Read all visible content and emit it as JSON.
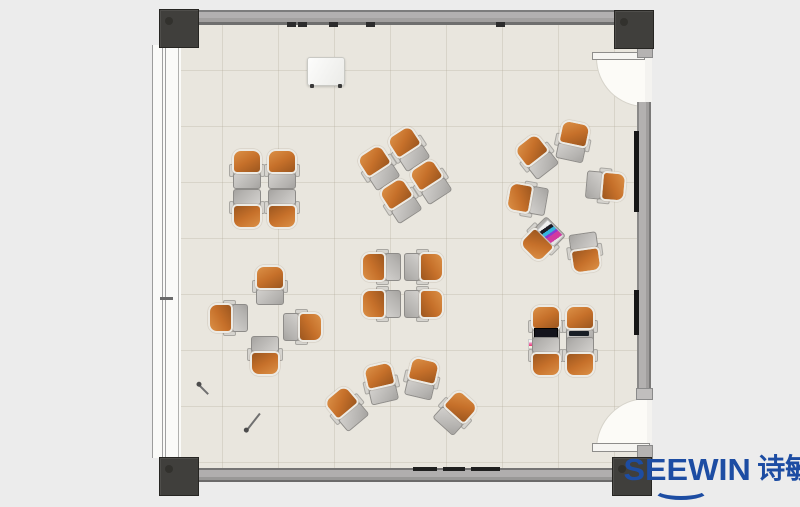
{
  "logo": {
    "brand_latin": "SEEWIN",
    "brand_cjk": "诗敏",
    "color": "#1d4da3"
  },
  "palette": {
    "canvas_bg": "#ececec",
    "floor": "#e9e6de",
    "floor_grid": "#cfc8ba",
    "wall_gray": "#a8a6a5",
    "column_dark": "#403f3c",
    "seat_orange": "#c6702a",
    "seat_shell_white": "#eceae4",
    "desk_gray": "#b5b3b0",
    "door_swing_white": "#fcfbf7",
    "screen_black": "#161616"
  },
  "furniture": {
    "unit_size": {
      "w": 34,
      "h": 40
    },
    "units": [
      {
        "id": "a1",
        "x": 247,
        "y": 169,
        "rot": 0
      },
      {
        "id": "a2",
        "x": 282,
        "y": 169,
        "rot": 0
      },
      {
        "id": "a3",
        "x": 247,
        "y": 209,
        "rot": 180
      },
      {
        "id": "a4",
        "x": 282,
        "y": 209,
        "rot": 180
      },
      {
        "id": "b1",
        "x": 378,
        "y": 167,
        "rot": -33
      },
      {
        "id": "b2",
        "x": 408,
        "y": 148,
        "rot": -33
      },
      {
        "id": "b3",
        "x": 400,
        "y": 200,
        "rot": -33
      },
      {
        "id": "b4",
        "x": 430,
        "y": 181,
        "rot": -33
      },
      {
        "id": "c1",
        "x": 573,
        "y": 141,
        "rot": 12
      },
      {
        "id": "c2",
        "x": 536,
        "y": 156,
        "rot": -38
      },
      {
        "id": "c3",
        "x": 527,
        "y": 199,
        "rot": -80
      },
      {
        "id": "c4",
        "x": 542,
        "y": 240,
        "rot": -135,
        "decor": "papers"
      },
      {
        "id": "c5",
        "x": 585,
        "y": 253,
        "rot": 172
      },
      {
        "id": "c6",
        "x": 606,
        "y": 186,
        "rot": 95
      },
      {
        "id": "d1",
        "x": 270,
        "y": 285,
        "rot": 0
      },
      {
        "id": "d2",
        "x": 228,
        "y": 318,
        "rot": -90
      },
      {
        "id": "d3",
        "x": 303,
        "y": 327,
        "rot": 90
      },
      {
        "id": "d4",
        "x": 265,
        "y": 356,
        "rot": 180
      },
      {
        "id": "e1",
        "x": 381,
        "y": 267,
        "rot": -90
      },
      {
        "id": "e2",
        "x": 424,
        "y": 267,
        "rot": 90
      },
      {
        "id": "e3",
        "x": 381,
        "y": 304,
        "rot": -90
      },
      {
        "id": "e4",
        "x": 424,
        "y": 304,
        "rot": 90
      },
      {
        "id": "f1",
        "x": 346,
        "y": 408,
        "rot": -40
      },
      {
        "id": "f2",
        "x": 381,
        "y": 383,
        "rot": -13
      },
      {
        "id": "f3",
        "x": 422,
        "y": 378,
        "rot": 13
      },
      {
        "id": "f4",
        "x": 456,
        "y": 412,
        "rot": 42
      },
      {
        "id": "g1",
        "x": 546,
        "y": 325,
        "rot": 0,
        "decor": "laptop-open"
      },
      {
        "id": "g2",
        "x": 580,
        "y": 325,
        "rot": 0,
        "decor": "laptop-closed"
      },
      {
        "id": "g3",
        "x": 546,
        "y": 357,
        "rot": 180
      },
      {
        "id": "g4",
        "x": 580,
        "y": 357,
        "rot": 180
      }
    ]
  },
  "props": {
    "pens": [
      {
        "x": 199,
        "y": 384,
        "len": 13,
        "angle": 45
      },
      {
        "x": 247,
        "y": 429,
        "len": 21,
        "angle": -52
      }
    ],
    "top_wall_marks_x": [
      287,
      298,
      329,
      366,
      496
    ],
    "bottom_wall_marks": [
      {
        "x": 413,
        "w": 24
      },
      {
        "x": 443,
        "w": 22
      },
      {
        "x": 471,
        "w": 29
      }
    ],
    "right_wall_screens": [
      {
        "y": 131,
        "h": 81
      },
      {
        "y": 290,
        "h": 45
      }
    ]
  }
}
